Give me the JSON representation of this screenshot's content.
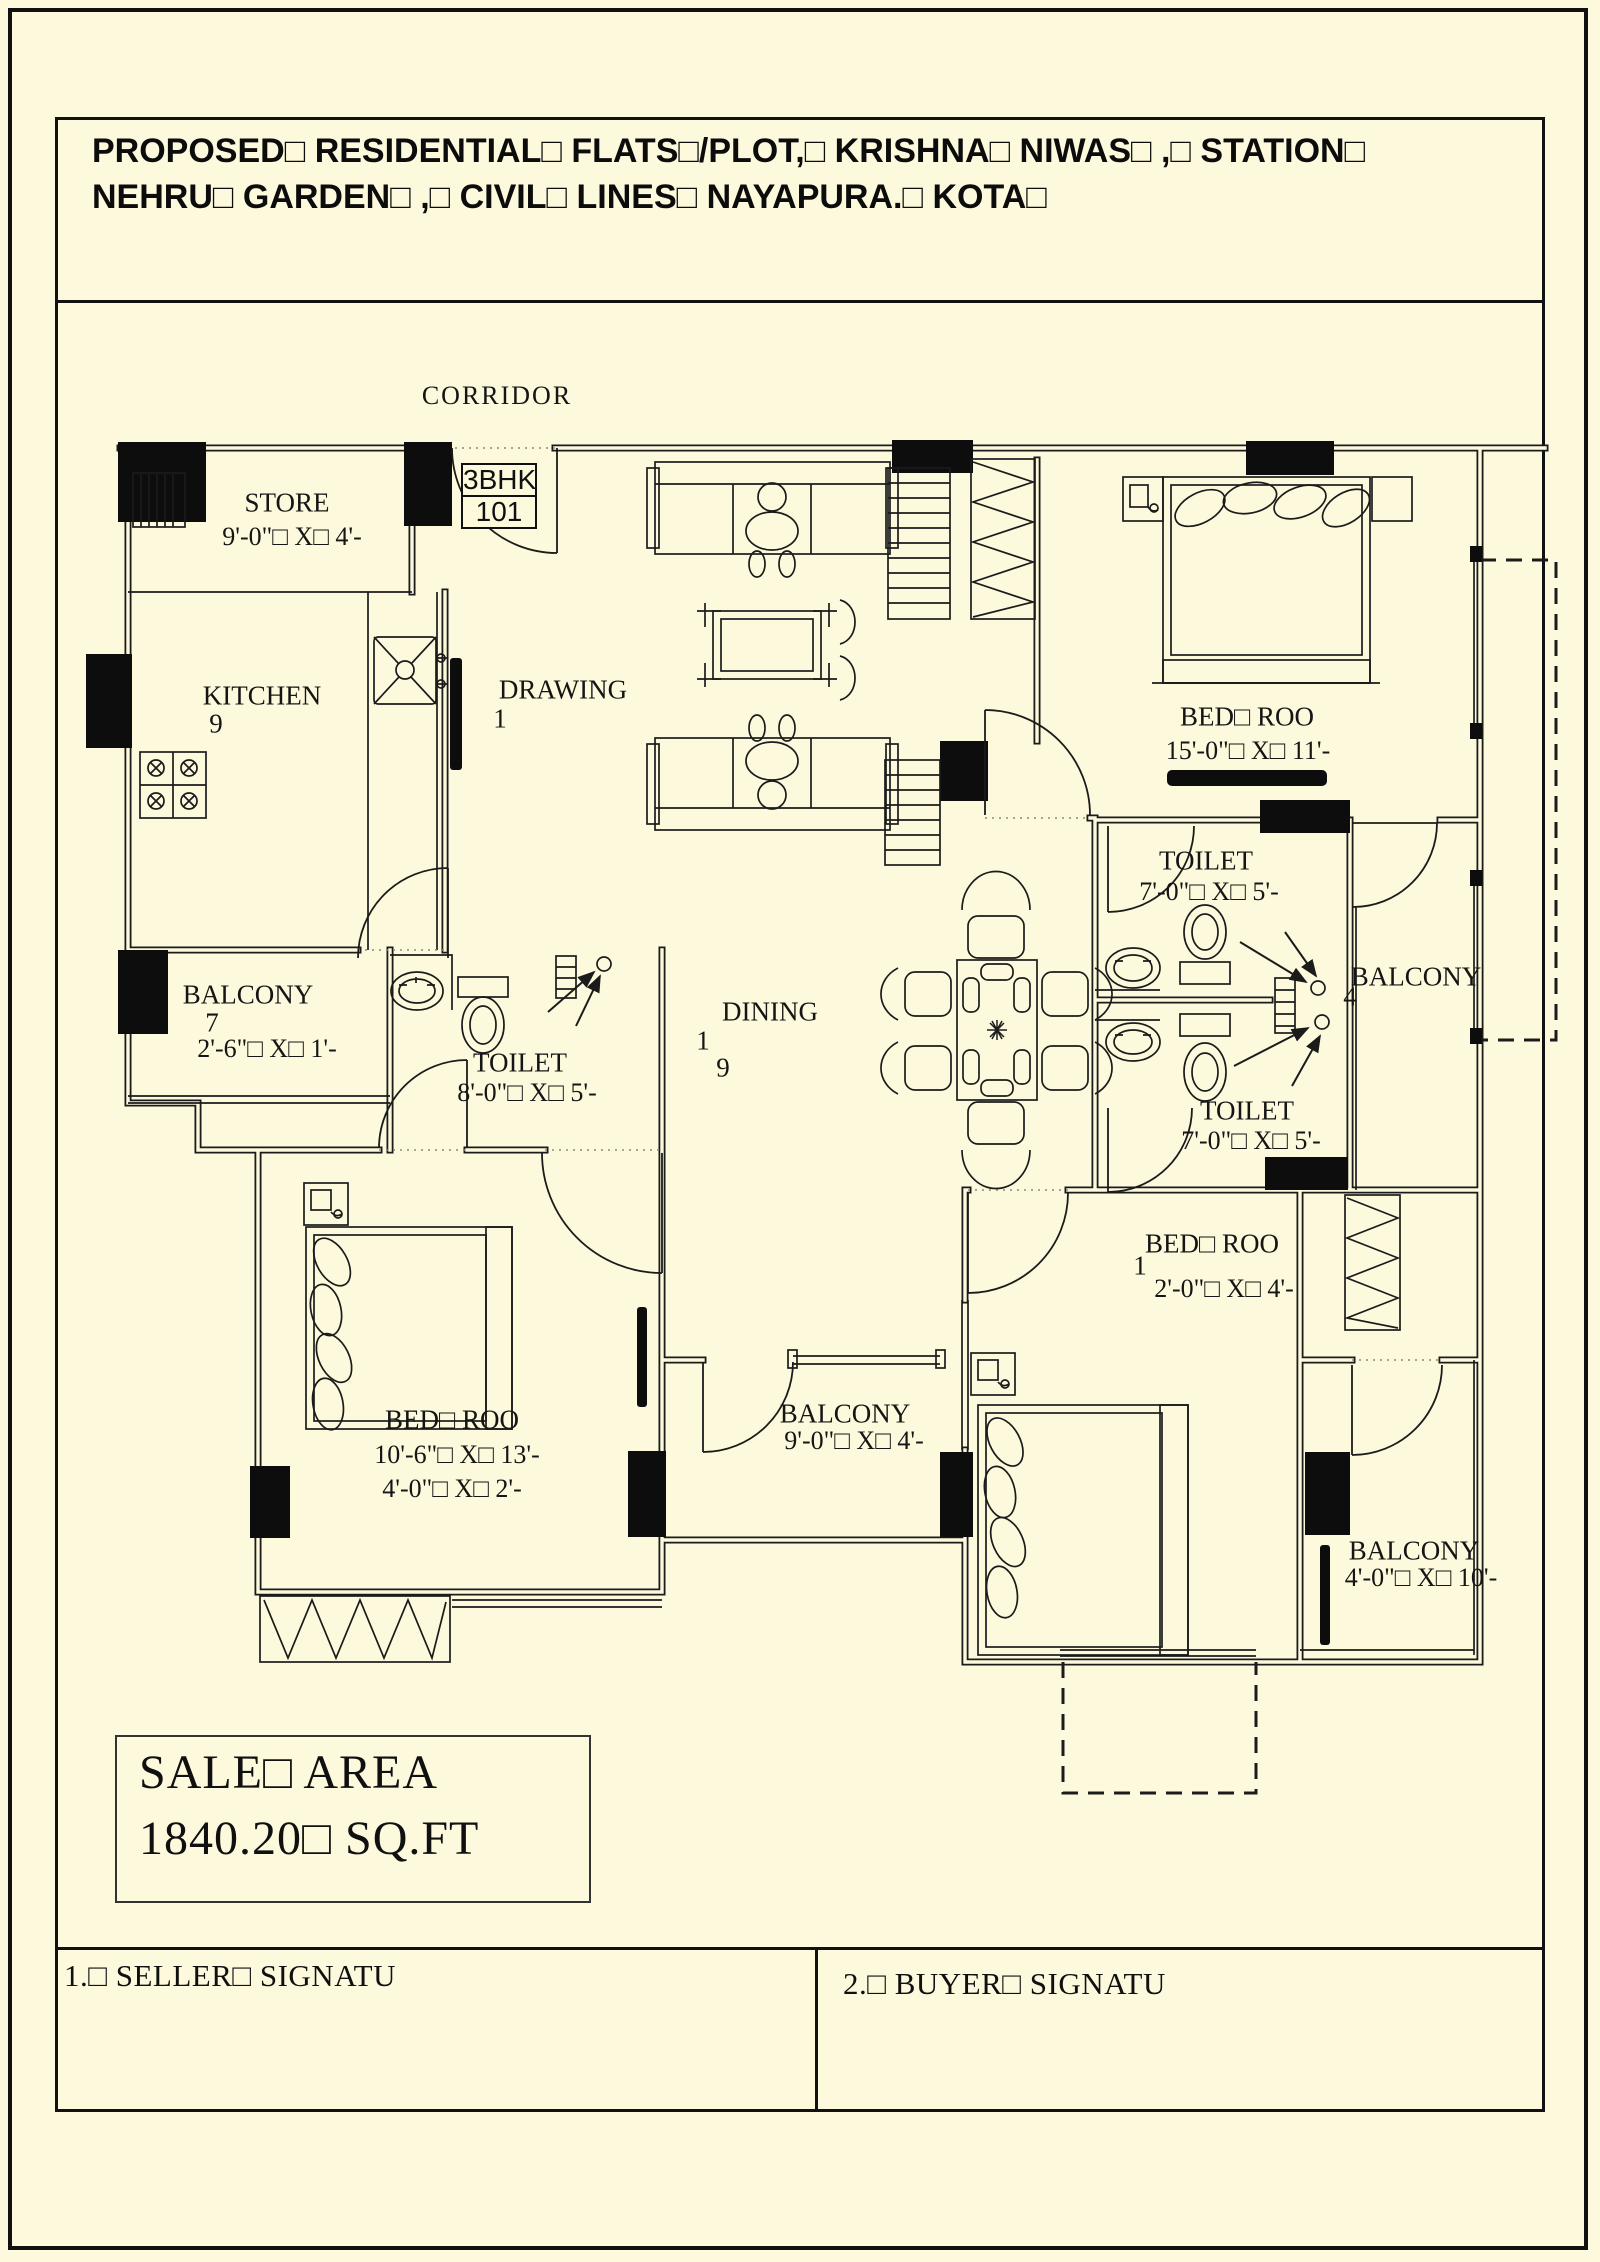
{
  "page": {
    "bg": "#fdf9dc",
    "line_color": "#111111"
  },
  "title": {
    "line1": "PROPOSED□ RESIDENTIAL□ FLATS□/PLOT,□ KRISHNA□ NIWAS□ ,□ STATION□",
    "line2": "NEHRU□ GARDEN□ ,□ CIVIL□ LINES□ NAYAPURA.□ KOTA□"
  },
  "plan": {
    "unit": {
      "type": "3BHK",
      "number": "101"
    },
    "labels": [
      {
        "id": "corridor",
        "text": "CORRIDOR",
        "x": 497,
        "y": 396,
        "cls": "corridor"
      },
      {
        "id": "store-name",
        "text": "STORE",
        "x": 287,
        "y": 503
      },
      {
        "id": "store-dims",
        "text": "9'-0\"□ X□ 4'-",
        "x": 292,
        "y": 537,
        "cls": "dims"
      },
      {
        "id": "kitchen-name",
        "text": "KITCHEN",
        "x": 262,
        "y": 696
      },
      {
        "id": "kitchen-stray",
        "text": "9",
        "x": 216,
        "y": 724
      },
      {
        "id": "drawing-name",
        "text": "DRAWING",
        "x": 563,
        "y": 690
      },
      {
        "id": "drawing-stray",
        "text": "1",
        "x": 500,
        "y": 719
      },
      {
        "id": "bedroom1-name",
        "text": "BED□ ROO",
        "x": 1247,
        "y": 717
      },
      {
        "id": "bedroom1-dims",
        "text": "15'-0\"□ X□ 11'-",
        "x": 1248,
        "y": 751,
        "cls": "dims"
      },
      {
        "id": "toilet1-name",
        "text": "TOILET",
        "x": 1206,
        "y": 861
      },
      {
        "id": "toilet1-dims",
        "text": "7'-0\"□ X□ 5'-",
        "x": 1209,
        "y": 892,
        "cls": "dims"
      },
      {
        "id": "balcony1-name",
        "text": "BALCONY",
        "x": 1416,
        "y": 977
      },
      {
        "id": "balcony1-stray",
        "text": "4",
        "x": 1350,
        "y": 997
      },
      {
        "id": "toilet2-name",
        "text": "TOILET",
        "x": 1247,
        "y": 1111
      },
      {
        "id": "toilet2-dims",
        "text": "7'-0\"□ X□ 5'-",
        "x": 1251,
        "y": 1141,
        "cls": "dims"
      },
      {
        "id": "dining-name",
        "text": "DINING",
        "x": 770,
        "y": 1012
      },
      {
        "id": "dining-stray1",
        "text": "1",
        "x": 703,
        "y": 1041
      },
      {
        "id": "dining-stray2",
        "text": "9",
        "x": 723,
        "y": 1068
      },
      {
        "id": "balcony2-name",
        "text": "BALCONY",
        "x": 248,
        "y": 995
      },
      {
        "id": "balcony2-stray",
        "text": "7",
        "x": 212,
        "y": 1023
      },
      {
        "id": "balcony2-dims",
        "text": "2'-6\"□ X□ 1'-",
        "x": 267,
        "y": 1049,
        "cls": "dims"
      },
      {
        "id": "toilet3-name",
        "text": "TOILET",
        "x": 520,
        "y": 1063
      },
      {
        "id": "toilet3-dims",
        "text": "8'-0\"□ X□ 5'-",
        "x": 527,
        "y": 1093,
        "cls": "dims"
      },
      {
        "id": "bedroom2-name",
        "text": "BED□ ROO",
        "x": 452,
        "y": 1420
      },
      {
        "id": "bedroom2-dims1",
        "text": "10'-6\"□ X□ 13'-",
        "x": 457,
        "y": 1455,
        "cls": "dims"
      },
      {
        "id": "bedroom2-dims2",
        "text": "4'-0\"□ X□ 2'-",
        "x": 452,
        "y": 1489,
        "cls": "dims"
      },
      {
        "id": "balcony3-name",
        "text": "BALCONY",
        "x": 845,
        "y": 1414
      },
      {
        "id": "balcony3-dims",
        "text": "9'-0\"□ X□ 4'-",
        "x": 854,
        "y": 1441,
        "cls": "dims"
      },
      {
        "id": "bedroom3-name",
        "text": "BED□ ROO",
        "x": 1212,
        "y": 1244
      },
      {
        "id": "bedroom3-stray",
        "text": "1",
        "x": 1140,
        "y": 1266
      },
      {
        "id": "bedroom3-dims",
        "text": "2'-0\"□ X□ 4'-",
        "x": 1224,
        "y": 1289,
        "cls": "dims"
      },
      {
        "id": "balcony4-name",
        "text": "BALCONY",
        "x": 1414,
        "y": 1551
      },
      {
        "id": "balcony4-dims",
        "text": "4'-0\"□ X□ 10'-",
        "x": 1421,
        "y": 1578,
        "cls": "dims"
      }
    ]
  },
  "sale_area": {
    "line1": "SALE□ AREA",
    "line2": "1840.20□ SQ.FT"
  },
  "signatures": {
    "seller": "1.□ SELLER□ SIGNATU",
    "buyer": "2.□ BUYER□ SIGNATU"
  }
}
